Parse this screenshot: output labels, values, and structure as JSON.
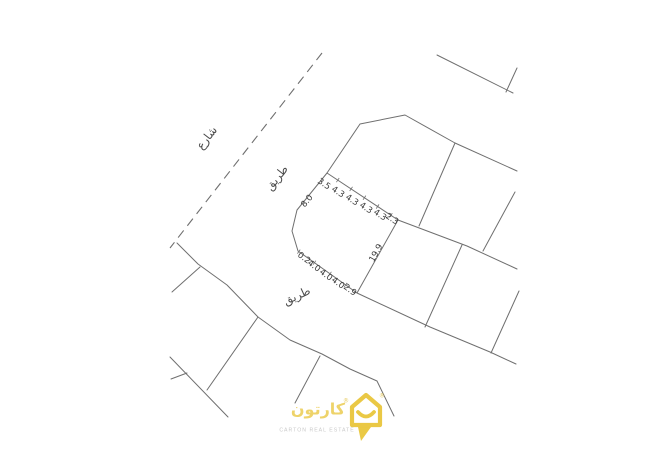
{
  "drawing": {
    "road_labels": {
      "street": "شارع",
      "road_upper": "طريق",
      "road_lower": "طريق"
    },
    "dimensions": {
      "top": [
        "3.5",
        "4.3",
        "4.3",
        "4.3",
        "4.3",
        "2.3"
      ],
      "bottom": [
        "0.2",
        "4.0",
        "4.0",
        "4.0",
        "2.9"
      ],
      "right": "19.9",
      "left": "8.0"
    },
    "colors": {
      "boundary_line": "#6f6f6f",
      "dimension_text": "#3a3a3a",
      "road_label_text": "#4a4a4a"
    }
  },
  "watermark": {
    "brand_arabic": "كارتون",
    "brand_english": "CARTON REAL ESTATE",
    "registered": "®",
    "colors": {
      "accent": "#e8c331",
      "english_text": "#c9c9c9"
    }
  }
}
